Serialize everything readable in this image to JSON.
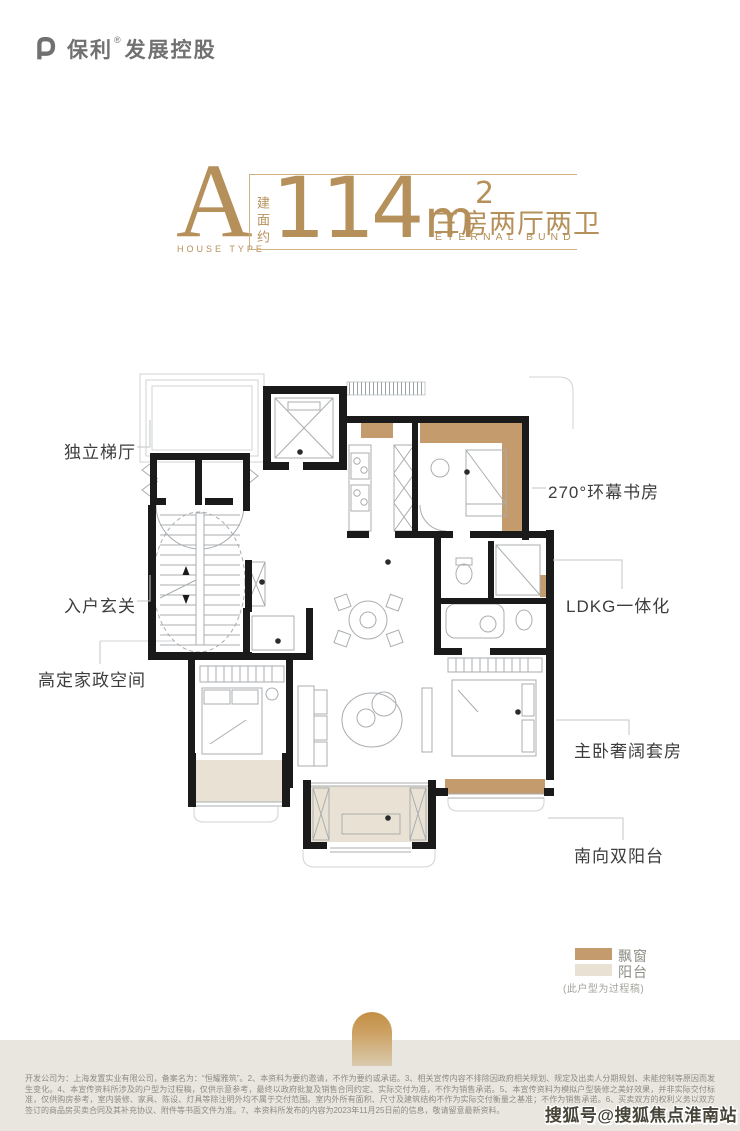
{
  "logo": {
    "brand": "保利",
    "reg": "®",
    "suffix": "发展控股"
  },
  "title": {
    "house_type_letter": "A",
    "house_type_label": "HOUSE TYPE",
    "area_prefix": "建面约",
    "area_number": "114",
    "area_unit": "m",
    "area_exponent": "2",
    "layout_cn": "三房两厅两卫",
    "layout_en": "ETERNAL BUND"
  },
  "plan_labels": {
    "left": [
      {
        "text": "独立梯厅"
      },
      {
        "text": "入户玄关"
      },
      {
        "text": "高定家政空间"
      }
    ],
    "right": [
      {
        "text": "270°环幕书房"
      },
      {
        "text": "LDKG一体化"
      },
      {
        "text": "主卧奢阔套房"
      },
      {
        "text": "南向双阳台"
      }
    ]
  },
  "legend": {
    "items": [
      {
        "label": "飘窗",
        "color": "#c39b6d"
      },
      {
        "label": "阳台",
        "color": "#e9e2d4"
      }
    ],
    "note": "(此户型为过程稿)"
  },
  "disclaimer": "开发公司为：上海发置实业有限公司，备案名为：“恒耀雅筑”。2、本资料为要约邀请，不作为要约或承诺。3、相关宣传内容不排除因政府相关规划、规定及出卖人分期规划、未能控制等原因而发生变化。4、本宣传资料所涉及的户型为过程稿，仅供示意参考，最终以政府批复及销售合同约定、实际交付为准，不作为销售承诺。5、本宣传资料为模拟户型装修之美好效果，并非实际交付标准，仅供购房参考，室内装修、家具、陈设、灯具等除注明外均不属于交付范围。室内外所有面积、尺寸及建筑结构不作为实际交付衡量之基准；不作为销售承诺。6、买卖双方的权利义务以双方签订的商品房买卖合同及其补充协议、附件等书面文件为准。7、本资料所发布的内容为2023年11月25日前的信息，敬请留意最新资料。",
  "watermark": "搜狐号@搜狐焦点淮南站",
  "colors": {
    "gold": "#b6905a",
    "bay_window": "#c39b6d",
    "balcony": "#e9e2d4",
    "wall": "#1a1a1a",
    "footer_bg": "#e9e6df",
    "label_text": "#3d3d3d"
  }
}
